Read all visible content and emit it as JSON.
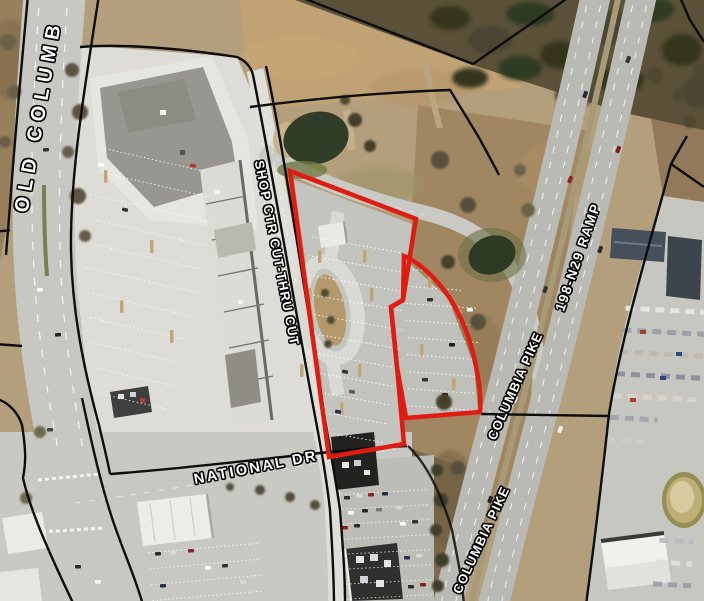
{
  "map": {
    "title": "Aerial parcel map with highlighted parcel",
    "colors": {
      "parcel_highlight": "#e01b12",
      "boundary_line": "#0d0d0d",
      "label_text": "#ffffff"
    },
    "street_labels": [
      {
        "id": "old-columbia-pike",
        "text": "OLD COLUMB"
      },
      {
        "id": "shop-ctr-cut-thru",
        "text": "SHOP CTR CUT-THRU CUT"
      },
      {
        "id": "national-dr",
        "text": "NATIONAL DR"
      },
      {
        "id": "columbia-pike-north",
        "text": "COLUMBIA PIKE"
      },
      {
        "id": "columbia-pike-south",
        "text": "COLUMBIA PIKE"
      },
      {
        "id": "ramp-198-n29",
        "text": "198-N29 RAMP"
      }
    ]
  }
}
